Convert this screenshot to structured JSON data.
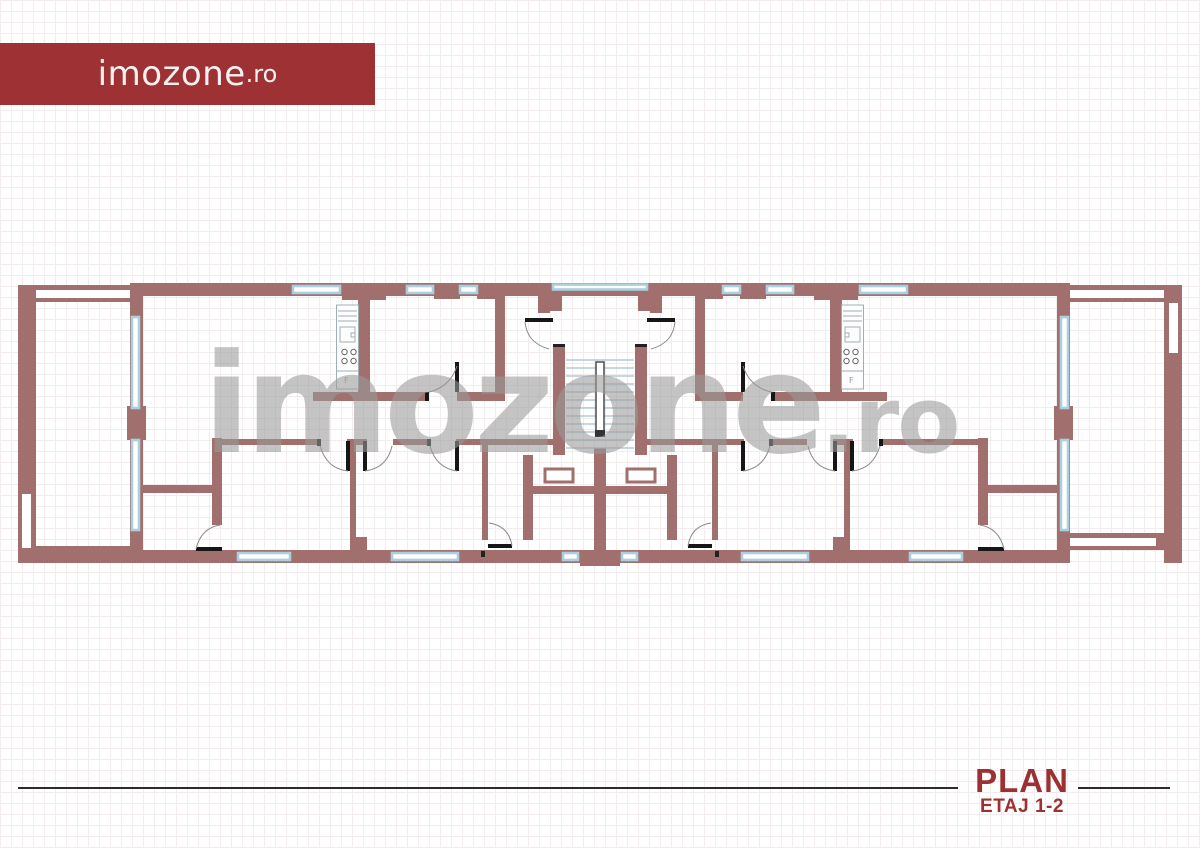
{
  "logo_banner": {
    "text_main": "imozone",
    "text_suffix": ".ro",
    "bg_color": "#9e3133",
    "text_color": "#f6f1ef"
  },
  "watermark": {
    "text_main": "imozone",
    "text_suffix": ".ro",
    "color": "#9b9b9b"
  },
  "title_block": {
    "title": "PLAN",
    "subtitle": "ETAJ 1-2",
    "color": "#9c3133",
    "rule_color": "#2b2b2b"
  },
  "floor_plan": {
    "wall_color": "#a06f6e",
    "window_color": "#aacfdf",
    "door_color": "#161616",
    "stair_tread_color": "#a3bfcc",
    "grid_color": "#f2ecec",
    "labels": {
      "fridge_left": "F",
      "fridge_right": "F"
    }
  }
}
